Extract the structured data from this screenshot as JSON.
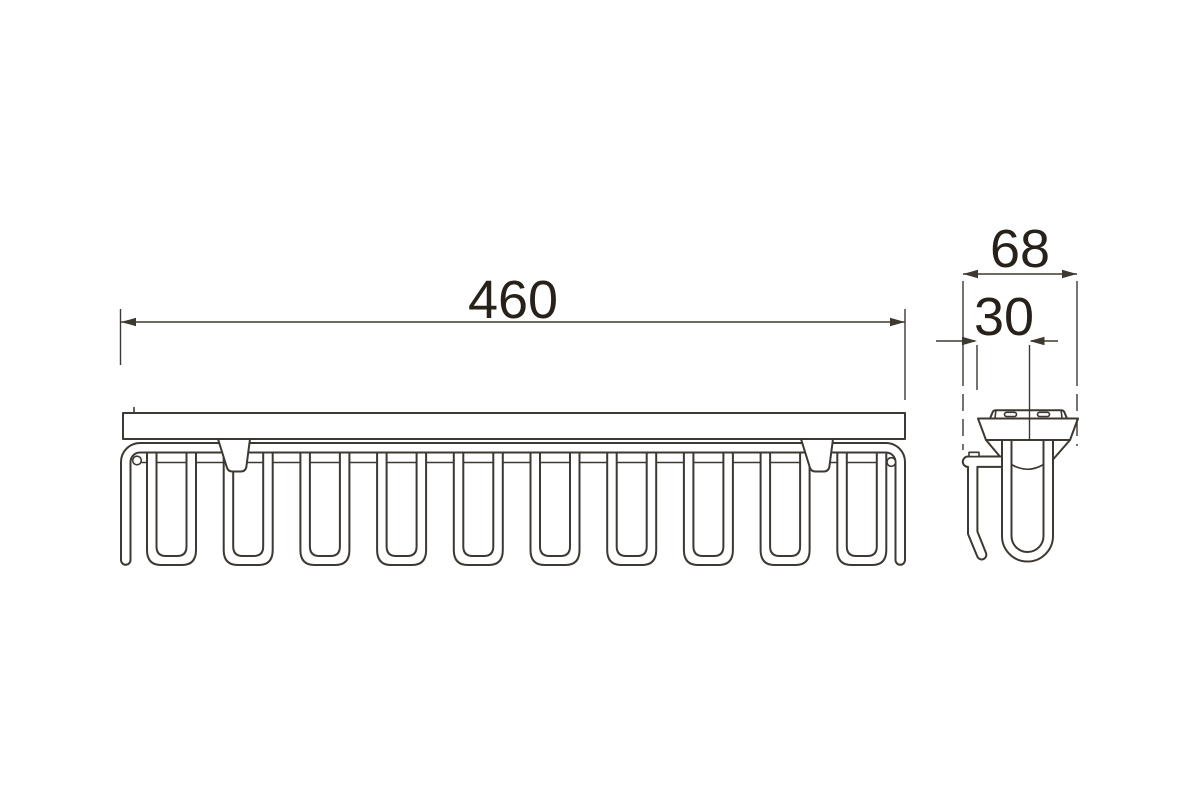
{
  "drawing_labels": {
    "length": "460",
    "depth": "68",
    "offset": "30"
  },
  "front_view": {
    "hook_count": 10
  },
  "colors": {
    "line": "#3d3831",
    "text": "#27211a",
    "background": "#ffffff"
  }
}
